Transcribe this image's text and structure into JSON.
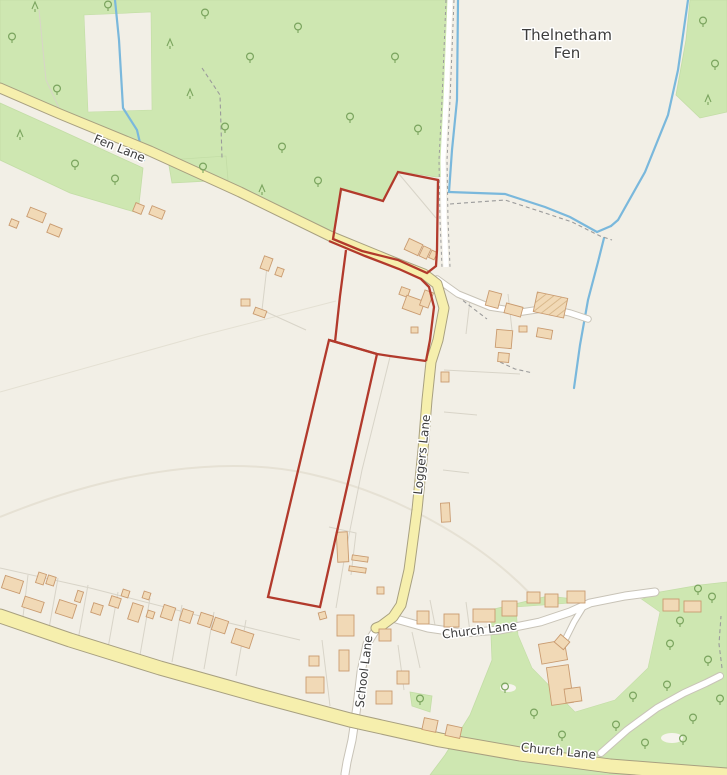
{
  "map": {
    "attribution": "",
    "colors": {
      "bg": "#f2efe6",
      "green": "#cee7b1",
      "green_edge": "#c3dda6",
      "tree": "#7aa45e",
      "yellow_fill": "#f6efad",
      "yellow_casing": "#a8a080",
      "white_fill": "#ffffff",
      "white_casing": "#c8c3b7",
      "water": "#7ab8dc",
      "building_fill": "#f1d9b6",
      "building_stroke": "#c99b70",
      "parcel": "#d8d4c8",
      "parcel_faint": "#e4e0d3",
      "red": "#b23a2c",
      "label": "#3d3d3d",
      "halo": "#ffffff",
      "arc": "#e6e1d4",
      "dash": "#9b9b9b",
      "clearing": "#f6f4ed"
    },
    "labels": [
      {
        "id": "place-thelnetham",
        "text": "Thelnetham",
        "x": 567,
        "y": 40,
        "rot": 0,
        "size": 15,
        "kind": "place"
      },
      {
        "id": "place-fen",
        "text": "Fen",
        "x": 567,
        "y": 58,
        "rot": 0,
        "size": 15,
        "kind": "place"
      },
      {
        "id": "road-fen-lane",
        "text": "Fen Lane",
        "x": 118,
        "y": 152,
        "rot": 22,
        "size": 12,
        "kind": "road"
      },
      {
        "id": "road-loggers-lane",
        "text": "Loggers Lane",
        "x": 426,
        "y": 455,
        "rot": -84,
        "size": 12,
        "kind": "road"
      },
      {
        "id": "road-church-lane-upper",
        "text": "Church Lane",
        "x": 480,
        "y": 634,
        "rot": -7,
        "size": 12,
        "kind": "road"
      },
      {
        "id": "road-school-lane",
        "text": "School Lane",
        "x": 368,
        "y": 672,
        "rot": -83,
        "size": 12,
        "kind": "road"
      },
      {
        "id": "road-church-lane-lower",
        "text": "Church Lane",
        "x": 558,
        "y": 755,
        "rot": 6,
        "size": 12,
        "kind": "road"
      }
    ],
    "greens": [
      "0,0 447,0 445,176 436,177 398,171 383,201 342,189 333,238 240,191 150,151 60,113 0,83",
      "690,0 727,0 727,112 700,118 676,95 686,40",
      "0,103 60,130 143,168 138,213 70,193 0,160",
      "168,160 226,156 228,180 172,183",
      "490,610 548,596 583,600 620,608 660,592 700,585 727,582 727,775 430,775 445,755 470,715 492,660",
      "410,692 432,696 430,712 412,706"
    ],
    "green_carves": [
      "84,15 151,12 152,110 88,112",
      "516,607 640,598 660,612 648,668 615,700 575,712 532,668 518,635"
    ],
    "clearings": [
      {
        "cx": 508,
        "cy": 688,
        "rx": 8,
        "ry": 4
      },
      {
        "cx": 672,
        "cy": 738,
        "rx": 11,
        "ry": 5
      }
    ],
    "faint_arc": "M0,517 C120,468 230,456 310,474 C400,494 495,548 548,614",
    "parcel_lines": [
      "399,174 436,218",
      "390,357 362,470 345,555 336,608",
      "444,370 520,374",
      "444,412 477,415",
      "443,470 469,473",
      "268,258 262,310",
      "262,310 306,330",
      "28,575 22,625",
      "58,578 48,634",
      "88,585 78,640",
      "118,592 108,648",
      "150,598 140,655",
      "182,605 172,662",
      "214,612 204,669",
      "246,620 236,676",
      "0,568 90,588 200,616 300,640",
      "322,640 330,706",
      "398,645 404,690",
      "412,632 420,668",
      "430,600 436,630",
      "466,602 470,632",
      "508,294 512,330",
      "470,300 466,334",
      "329,527 356,533 351,575",
      "39,10 46,80 60,110"
    ],
    "parcel_faint_lines": [
      "0,392 200,336 336,301"
    ],
    "water": [
      "688,0 678,70 668,115 645,172 618,220 611,226",
      "611,226 597,232 570,217 545,207 505,194 449,192",
      "449,192 452,150 457,100 458,0",
      "604,238 598,262 588,300 580,345 574,388",
      "115,0 119,40 123,108 137,130 144,160"
    ],
    "dashed_paths": [
      "202,68 220,95 222,158",
      "450,204 505,200 545,213 572,222 600,236 612,240",
      "452,292 470,306 487,319",
      "722,668 719,644 721,616",
      "500,362 515,369 533,373"
    ],
    "white_roads": [
      {
        "points": "377,628 367,644 361,672 357,706 352,740 347,762 345,774",
        "width": 7
      },
      {
        "points": "396,619 428,628 462,633 500,630 540,622 570,612 590,603 625,596 655,592",
        "width": 7
      },
      {
        "points": "437,279 458,294 490,307 522,312 548,308 570,313 588,319",
        "width": 5.5
      },
      {
        "points": "585,604 574,622 566,638",
        "width": 5
      },
      {
        "points": "601,753 627,730 657,708 684,693 706,683 720,676",
        "width": 6
      }
    ],
    "yellow_roads": [
      {
        "points": "0,88 60,114 150,151 240,192 330,236 396,263 424,274 437,284 444,308 438,340 431,362 427,400 423,450 417,510 409,570 401,605 393,617 381,626 376,628",
        "width": 9
      },
      {
        "points": "0,616 70,640 160,668 260,696 350,720 440,740 520,754 610,766 700,773 727,775",
        "width": 13
      }
    ],
    "track": {
      "fill_points": "450,0 446,100 443,160 444,220 446,267",
      "edge1": "446,0 442,100 439,160 440,220 442,267",
      "edge2": "454,0 450,100 447,160 448,220 450,267"
    },
    "red_boundary": {
      "closed": [
        "333,239 341,189 383,201 398,172 438,180 437,250 436,266 427,273 398,260 362,251",
        "329,340 377,354 320,607 268,597"
      ],
      "open": [
        "329,241 365,256 399,269 421,279 429,287 434,307 430,340 426,361",
        "426,361 390,356 377,354 336,342 329,340",
        "346,250 340,296 335,342"
      ]
    },
    "buildings": [
      {
        "x": 28,
        "y": 210,
        "w": 17,
        "h": 10,
        "r": 22
      },
      {
        "x": 48,
        "y": 226,
        "w": 13,
        "h": 9,
        "r": 22
      },
      {
        "x": 10,
        "y": 220,
        "w": 8,
        "h": 7,
        "r": 22
      },
      {
        "x": 134,
        "y": 204,
        "w": 9,
        "h": 9,
        "r": 22
      },
      {
        "x": 150,
        "y": 208,
        "w": 14,
        "h": 9,
        "r": 22
      },
      {
        "x": 262,
        "y": 257,
        "w": 9,
        "h": 13,
        "r": 20
      },
      {
        "x": 276,
        "y": 268,
        "w": 7,
        "h": 8,
        "r": 20
      },
      {
        "x": 241,
        "y": 299,
        "w": 9,
        "h": 7,
        "r": 0
      },
      {
        "x": 254,
        "y": 309,
        "w": 12,
        "h": 7,
        "r": 20
      },
      {
        "x": 406,
        "y": 241,
        "w": 15,
        "h": 12,
        "r": 25
      },
      {
        "x": 421,
        "y": 247,
        "w": 8,
        "h": 11,
        "r": 25
      },
      {
        "x": 430,
        "y": 251,
        "w": 6,
        "h": 8,
        "r": 25
      },
      {
        "x": 400,
        "y": 288,
        "w": 9,
        "h": 8,
        "r": 20
      },
      {
        "x": 404,
        "y": 298,
        "w": 19,
        "h": 14,
        "r": 20
      },
      {
        "x": 422,
        "y": 291,
        "w": 9,
        "h": 16,
        "r": 20
      },
      {
        "x": 411,
        "y": 327,
        "w": 7,
        "h": 6,
        "r": 0
      },
      {
        "x": 487,
        "y": 292,
        "w": 13,
        "h": 15,
        "r": 15
      },
      {
        "x": 505,
        "y": 305,
        "w": 17,
        "h": 10,
        "r": 15
      },
      {
        "x": 535,
        "y": 295,
        "w": 31,
        "h": 20,
        "r": 12,
        "gh": true
      },
      {
        "x": 519,
        "y": 326,
        "w": 8,
        "h": 6,
        "r": 0
      },
      {
        "x": 537,
        "y": 329,
        "w": 15,
        "h": 9,
        "r": 10
      },
      {
        "x": 496,
        "y": 330,
        "w": 16,
        "h": 18,
        "r": 5
      },
      {
        "x": 498,
        "y": 353,
        "w": 11,
        "h": 9,
        "r": 5
      },
      {
        "x": 441,
        "y": 372,
        "w": 8,
        "h": 10,
        "r": 0
      },
      {
        "x": 441,
        "y": 503,
        "w": 9,
        "h": 19,
        "r": -3
      },
      {
        "x": 337,
        "y": 532,
        "w": 11,
        "h": 30,
        "r": -3
      },
      {
        "x": 352,
        "y": 556,
        "w": 16,
        "h": 5,
        "r": 8
      },
      {
        "x": 349,
        "y": 567,
        "w": 17,
        "h": 5,
        "r": 8
      },
      {
        "x": 377,
        "y": 587,
        "w": 7,
        "h": 7,
        "r": 0
      },
      {
        "x": 319,
        "y": 612,
        "w": 7,
        "h": 7,
        "r": -15
      },
      {
        "x": 337,
        "y": 615,
        "w": 17,
        "h": 21,
        "r": 0
      },
      {
        "x": 339,
        "y": 650,
        "w": 10,
        "h": 21,
        "r": 0
      },
      {
        "x": 309,
        "y": 656,
        "w": 10,
        "h": 10,
        "r": 0
      },
      {
        "x": 306,
        "y": 677,
        "w": 18,
        "h": 16,
        "r": 0
      },
      {
        "x": 379,
        "y": 629,
        "w": 12,
        "h": 12,
        "r": 0
      },
      {
        "x": 397,
        "y": 671,
        "w": 12,
        "h": 13,
        "r": 0
      },
      {
        "x": 376,
        "y": 691,
        "w": 16,
        "h": 13,
        "r": 0
      },
      {
        "x": 417,
        "y": 611,
        "w": 12,
        "h": 13,
        "r": 0
      },
      {
        "x": 444,
        "y": 614,
        "w": 15,
        "h": 13,
        "r": 0
      },
      {
        "x": 473,
        "y": 609,
        "w": 22,
        "h": 13,
        "r": 0
      },
      {
        "x": 502,
        "y": 601,
        "w": 15,
        "h": 15,
        "r": 0
      },
      {
        "x": 527,
        "y": 592,
        "w": 13,
        "h": 11,
        "r": 0
      },
      {
        "x": 545,
        "y": 594,
        "w": 13,
        "h": 13,
        "r": 0
      },
      {
        "x": 567,
        "y": 591,
        "w": 18,
        "h": 12,
        "r": 0
      },
      {
        "x": 663,
        "y": 599,
        "w": 16,
        "h": 12,
        "r": 0
      },
      {
        "x": 684,
        "y": 601,
        "w": 17,
        "h": 11,
        "r": 0
      },
      {
        "x": 540,
        "y": 642,
        "w": 26,
        "h": 20,
        "r": -10
      },
      {
        "x": 556,
        "y": 637,
        "w": 12,
        "h": 10,
        "r": 40
      },
      {
        "x": 549,
        "y": 666,
        "w": 22,
        "h": 38,
        "r": -8
      },
      {
        "x": 565,
        "y": 688,
        "w": 16,
        "h": 14,
        "r": -8
      },
      {
        "x": 423,
        "y": 719,
        "w": 14,
        "h": 12,
        "r": 12
      },
      {
        "x": 446,
        "y": 726,
        "w": 15,
        "h": 11,
        "r": 12
      },
      {
        "x": 3,
        "y": 578,
        "w": 19,
        "h": 13,
        "r": 18
      },
      {
        "x": 23,
        "y": 599,
        "w": 20,
        "h": 11,
        "r": 18
      },
      {
        "x": 37,
        "y": 573,
        "w": 8,
        "h": 11,
        "r": 18
      },
      {
        "x": 47,
        "y": 576,
        "w": 8,
        "h": 9,
        "r": 18
      },
      {
        "x": 57,
        "y": 602,
        "w": 18,
        "h": 14,
        "r": 18
      },
      {
        "x": 76,
        "y": 591,
        "w": 6,
        "h": 11,
        "r": 18
      },
      {
        "x": 92,
        "y": 604,
        "w": 10,
        "h": 10,
        "r": 18
      },
      {
        "x": 110,
        "y": 597,
        "w": 10,
        "h": 10,
        "r": 18
      },
      {
        "x": 130,
        "y": 604,
        "w": 11,
        "h": 17,
        "r": 18
      },
      {
        "x": 147,
        "y": 611,
        "w": 7,
        "h": 7,
        "r": 18
      },
      {
        "x": 162,
        "y": 606,
        "w": 12,
        "h": 13,
        "r": 18
      },
      {
        "x": 181,
        "y": 610,
        "w": 11,
        "h": 12,
        "r": 18
      },
      {
        "x": 199,
        "y": 614,
        "w": 13,
        "h": 12,
        "r": 18
      },
      {
        "x": 213,
        "y": 619,
        "w": 14,
        "h": 13,
        "r": 18
      },
      {
        "x": 233,
        "y": 631,
        "w": 19,
        "h": 15,
        "r": 18
      },
      {
        "x": 122,
        "y": 590,
        "w": 7,
        "h": 7,
        "r": 18
      },
      {
        "x": 143,
        "y": 592,
        "w": 7,
        "h": 7,
        "r": 18
      }
    ],
    "trees": [
      {
        "x": 12,
        "y": 38,
        "t": "d"
      },
      {
        "x": 35,
        "y": 7,
        "t": "c"
      },
      {
        "x": 57,
        "y": 90,
        "t": "d"
      },
      {
        "x": 108,
        "y": 6,
        "t": "d"
      },
      {
        "x": 170,
        "y": 44,
        "t": "c"
      },
      {
        "x": 205,
        "y": 14,
        "t": "d"
      },
      {
        "x": 250,
        "y": 58,
        "t": "d"
      },
      {
        "x": 298,
        "y": 28,
        "t": "d"
      },
      {
        "x": 190,
        "y": 94,
        "t": "c"
      },
      {
        "x": 225,
        "y": 128,
        "t": "d"
      },
      {
        "x": 282,
        "y": 148,
        "t": "d"
      },
      {
        "x": 318,
        "y": 182,
        "t": "d"
      },
      {
        "x": 350,
        "y": 118,
        "t": "d"
      },
      {
        "x": 395,
        "y": 58,
        "t": "d"
      },
      {
        "x": 418,
        "y": 130,
        "t": "d"
      },
      {
        "x": 262,
        "y": 190,
        "t": "c"
      },
      {
        "x": 20,
        "y": 135,
        "t": "c"
      },
      {
        "x": 75,
        "y": 165,
        "t": "d"
      },
      {
        "x": 115,
        "y": 180,
        "t": "d"
      },
      {
        "x": 203,
        "y": 168,
        "t": "d"
      },
      {
        "x": 703,
        "y": 22,
        "t": "d"
      },
      {
        "x": 715,
        "y": 65,
        "t": "d"
      },
      {
        "x": 708,
        "y": 100,
        "t": "c"
      },
      {
        "x": 505,
        "y": 688,
        "t": "d"
      },
      {
        "x": 534,
        "y": 714,
        "t": "d"
      },
      {
        "x": 562,
        "y": 736,
        "t": "d"
      },
      {
        "x": 633,
        "y": 697,
        "t": "d"
      },
      {
        "x": 645,
        "y": 744,
        "t": "d"
      },
      {
        "x": 670,
        "y": 645,
        "t": "d"
      },
      {
        "x": 680,
        "y": 622,
        "t": "d"
      },
      {
        "x": 708,
        "y": 661,
        "t": "d"
      },
      {
        "x": 693,
        "y": 719,
        "t": "d"
      },
      {
        "x": 683,
        "y": 740,
        "t": "d"
      },
      {
        "x": 712,
        "y": 598,
        "t": "d"
      },
      {
        "x": 667,
        "y": 686,
        "t": "d"
      },
      {
        "x": 616,
        "y": 726,
        "t": "d"
      },
      {
        "x": 720,
        "y": 700,
        "t": "d"
      },
      {
        "x": 698,
        "y": 590,
        "t": "d"
      },
      {
        "x": 420,
        "y": 700,
        "t": "d"
      }
    ]
  }
}
